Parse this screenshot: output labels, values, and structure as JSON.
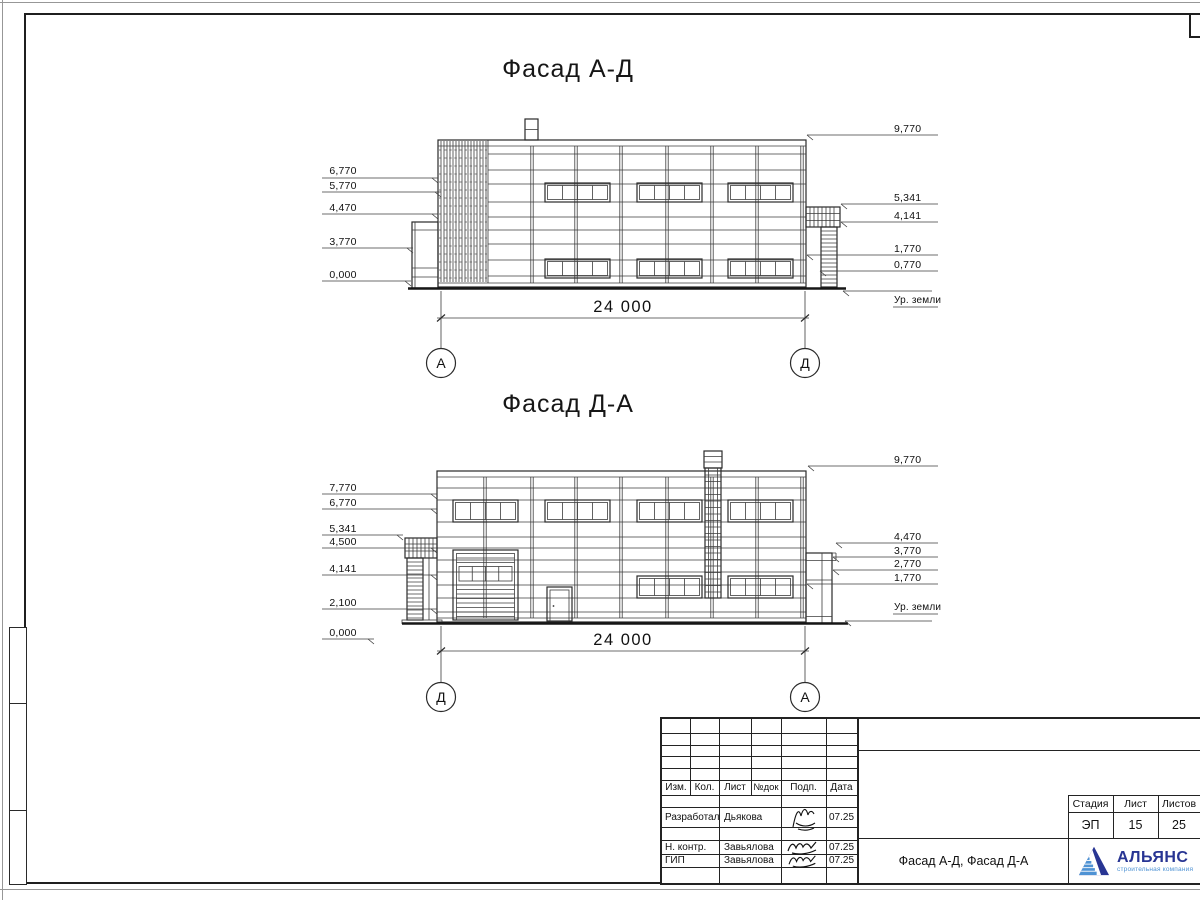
{
  "facade1": {
    "title": "Фасад А-Д",
    "span_dimension": "24 000",
    "axis_left": "А",
    "axis_right": "Д",
    "left_elevations": [
      "6,770",
      "5,770",
      "4,470",
      "3,770",
      "0,000"
    ],
    "right_elevations": [
      "9,770",
      "5,341",
      "4,141",
      "1,770",
      "0,770"
    ],
    "ground_label": "Ур. земли"
  },
  "facade2": {
    "title": "Фасад Д-А",
    "span_dimension": "24 000",
    "axis_left": "Д",
    "axis_right": "А",
    "left_elevations": [
      "7,770",
      "6,770",
      "5,341",
      "4,500",
      "4,141",
      "2,100",
      "0,000"
    ],
    "right_elevations": [
      "9,770",
      "4,470",
      "3,770",
      "2,770",
      "1,770"
    ],
    "ground_label": "Ур. земли"
  },
  "title_block": {
    "revision_headers": [
      "Изм.",
      "Кол.",
      "Лист",
      "№док",
      "Подп.",
      "Дата"
    ],
    "staff_rows": [
      {
        "role": "Разработал",
        "name": "Дьякова",
        "date": "07.25"
      },
      {
        "role": "Н. контр.",
        "name": "Завьялова",
        "date": "07.25"
      },
      {
        "role": "ГИП",
        "name": "Завьялова",
        "date": "07.25"
      }
    ],
    "stage_header": "Стадия",
    "sheet_header": "Лист",
    "sheets_header": "Листов",
    "stage": "ЭП",
    "sheet_number": "15",
    "sheets_total": "25",
    "drawing_title": "Фасад А-Д, Фасад Д-А",
    "company": {
      "name": "АЛЬЯНС",
      "tagline": "строительная компания"
    }
  },
  "colors": {
    "logo_dark": "#283593",
    "logo_light": "#4f93d4"
  }
}
